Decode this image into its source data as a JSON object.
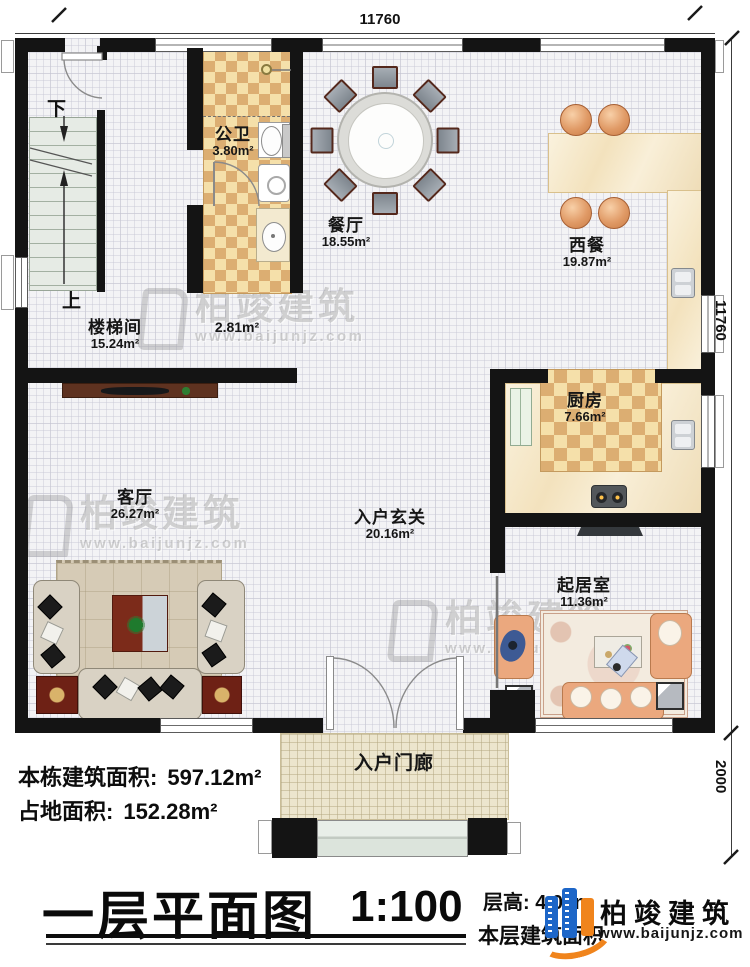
{
  "dimensions": {
    "top": "11760",
    "right": "11760",
    "right_lower": "2000"
  },
  "stairs": {
    "down": "下",
    "up": "上"
  },
  "rooms": {
    "gongwei": {
      "name": "公卫",
      "area": "3.80m²"
    },
    "canting": {
      "name": "餐厅",
      "area": "18.55m²"
    },
    "xican": {
      "name": "西餐",
      "area": "19.87m²"
    },
    "loutijian": {
      "name": "楼梯间",
      "area": "15.24m²"
    },
    "hall": {
      "area": "2.81m²"
    },
    "chufang": {
      "name": "厨房",
      "area": "7.66m²"
    },
    "keting": {
      "name": "客厅",
      "area": "26.27m²"
    },
    "xuanguan": {
      "name": "入户玄关",
      "area": "20.16m²"
    },
    "qijushi": {
      "name": "起居室",
      "area": "11.36m²"
    },
    "menlang": {
      "name": "入户门廊"
    }
  },
  "info": {
    "building_area_label": "本栋建筑面积:",
    "building_area_value": "597.12m²",
    "land_area_label": "占地面积:",
    "land_area_value": "152.28m²",
    "title": "一层平面图",
    "scale": "1:100",
    "floor_height": "层高: 4.01m",
    "floor_area_label": "本层建筑面积"
  },
  "watermark": {
    "brand": "柏竣建筑",
    "url": "www.baijunjz.com"
  },
  "logo": {
    "brand": "柏竣建筑",
    "url": "www.baijunjz.com"
  },
  "colors": {
    "wall": "#141414",
    "checker": "#dcae72",
    "marble": "#f6ecd2",
    "logo_blue": "#1d66c8",
    "logo_orange": "#f0841c"
  }
}
